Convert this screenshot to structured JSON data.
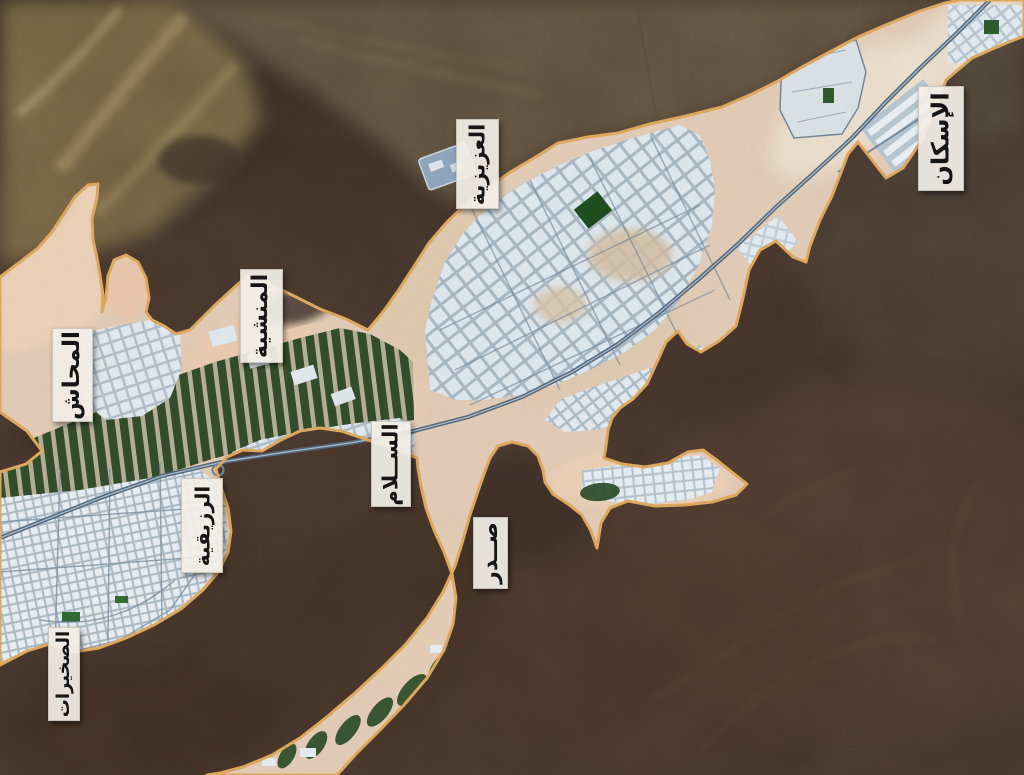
{
  "map": {
    "type": "satellite-map-with-district-labels",
    "boundary_color": "#dfa85e",
    "label_bg": "#f2eee6",
    "label_text_color": "#151515",
    "district_labels": [
      {
        "id": "iskan",
        "text": "الإسكان"
      },
      {
        "id": "aziziyah",
        "text": "العزيزية"
      },
      {
        "id": "manshiyah",
        "text": "المنشية"
      },
      {
        "id": "mahash",
        "text": "المحاش"
      },
      {
        "id": "salam",
        "text": "الســلام"
      },
      {
        "id": "ruzaiqiyah",
        "text": "الرزيقية"
      },
      {
        "id": "sadr",
        "text": "صــدر"
      },
      {
        "id": "sukhairat",
        "text": "الصخيرات"
      }
    ]
  }
}
